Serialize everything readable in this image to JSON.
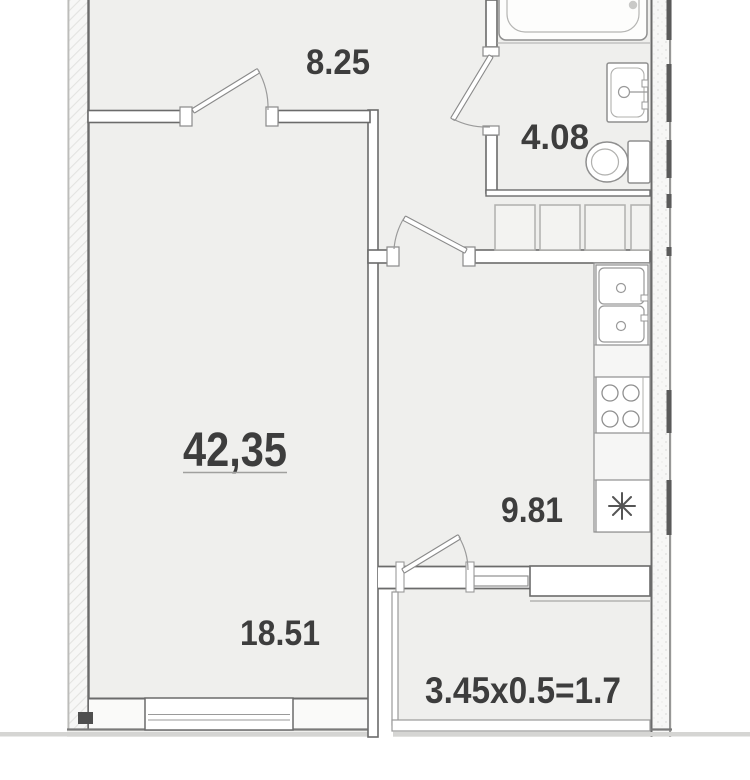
{
  "document": {
    "type": "apartment floor plan"
  },
  "rooms": {
    "hallway": {
      "name": "hallway",
      "area": "8.25"
    },
    "bathroom": {
      "name": "bathroom",
      "area": "4.08"
    },
    "kitchen": {
      "name": "kitchen",
      "area": "9.81"
    },
    "living_room": {
      "name": "living room",
      "area": "18.51"
    },
    "balcony": {
      "name": "balcony",
      "area": "3.45x0.5=1.7"
    },
    "total": {
      "name": "total area",
      "area": "42,35"
    }
  },
  "fixtures": {
    "bathroom": [
      "bathtub-icon",
      "sink-icon",
      "toilet-icon"
    ],
    "kitchen": [
      "double-sink-icon",
      "stove-icon",
      "counter",
      "refrigerator-icon"
    ],
    "hallway": [
      "wardrobe-icon"
    ]
  },
  "colors": {
    "background": "#ffffff",
    "floor": "#efefed",
    "wall_line": "#6b6b6b",
    "light_line": "#a8a8a8",
    "text": "#3d3d3d"
  }
}
